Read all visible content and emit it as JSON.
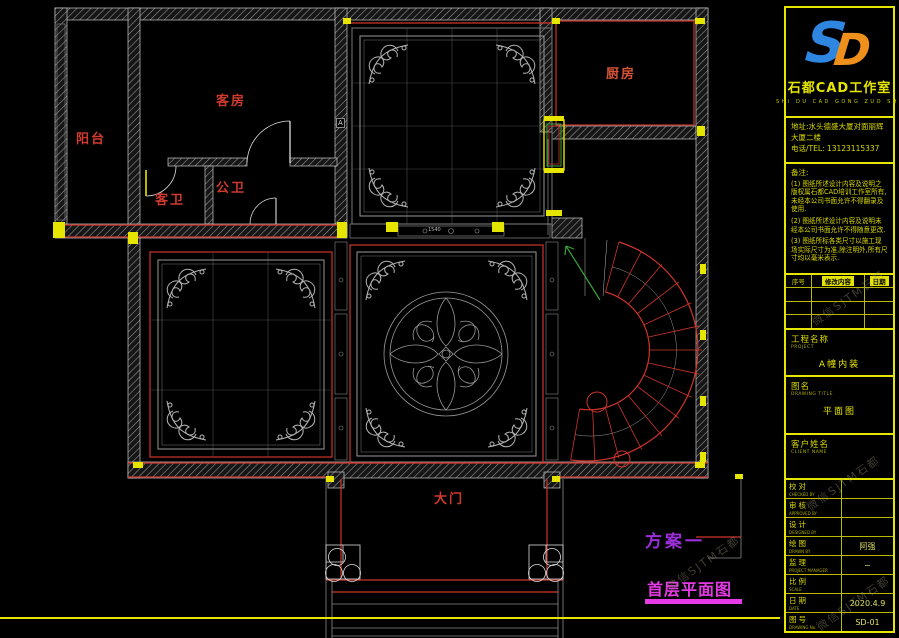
{
  "plan": {
    "rooms": {
      "balcony": "阳台",
      "guest_room": "客房",
      "kitchen": "厨房",
      "guest_bath": "客卫",
      "public_bath": "公卫",
      "main_gate": "大门"
    },
    "scheme_label": "方案一",
    "drawing_caption": "首层平面图",
    "section_marker": "A",
    "dim_text": "1540"
  },
  "title_block": {
    "logo": {
      "letter_s": "S",
      "letter_d": "D",
      "studio_name": "石都CAD工作室",
      "pinyin": "SHI DU CAD GONG ZUO SHI"
    },
    "address_line1": "地址:水头德盛大厦对面丽辉",
    "address_line2": "大厦二楼",
    "phone": "电话/TEL: 13123115337",
    "notes_title": "备注:",
    "notes": [
      "(1) 图纸所述设计内容及说明之版权属石都CAD培训工作室所有,未经本公司书面允许不得翻录及使用.",
      "(2) 图纸所述设计内容及说明未经本公司书面允许不得随意更改.",
      "(3) 图纸所标各类尺寸以施工现场实际尺寸为准,除注明外,所有尺寸均以毫米表示."
    ],
    "revision_headers": [
      "序号",
      "修改内容",
      "日期"
    ],
    "project": {
      "label_cn": "工程名称",
      "label_en": "PROJECT",
      "value": "A幢内装"
    },
    "drawing": {
      "label_cn": "图名",
      "label_en": "DRAWING TITLE",
      "value": "平面图"
    },
    "client": {
      "label_cn": "客户姓名",
      "label_en": "CLIENT NAME",
      "value": ""
    },
    "sign_rows": [
      {
        "cn": "校对",
        "en": "CHECKED BY",
        "value": ""
      },
      {
        "cn": "审核",
        "en": "APPROVED BY",
        "value": ""
      },
      {
        "cn": "设计",
        "en": "DESIGNED BY",
        "value": ""
      },
      {
        "cn": "绘图",
        "en": "DRAWN BY",
        "value": "阿强"
      },
      {
        "cn": "监理",
        "en": "PROJECT MANAGER",
        "value": "~"
      },
      {
        "cn": "比例",
        "en": "SCALE",
        "value": ""
      },
      {
        "cn": "日期",
        "en": "DATE",
        "value": "2020.4.9"
      },
      {
        "cn": "图号",
        "en": "DRAWING No.",
        "value": "SD-01"
      }
    ],
    "watermark": "微信SJTM石都"
  },
  "colors": {
    "cad_red": "#cf342b",
    "cad_yellow": "#e5e500",
    "caption_magenta": "#e53ae5",
    "scheme_purple": "#9b30d9",
    "arrow_green": "#3aa33a",
    "logo_blue": "#2e86e0",
    "logo_orange": "#ef8f1c",
    "wall_gray": "#9a9a9a"
  }
}
